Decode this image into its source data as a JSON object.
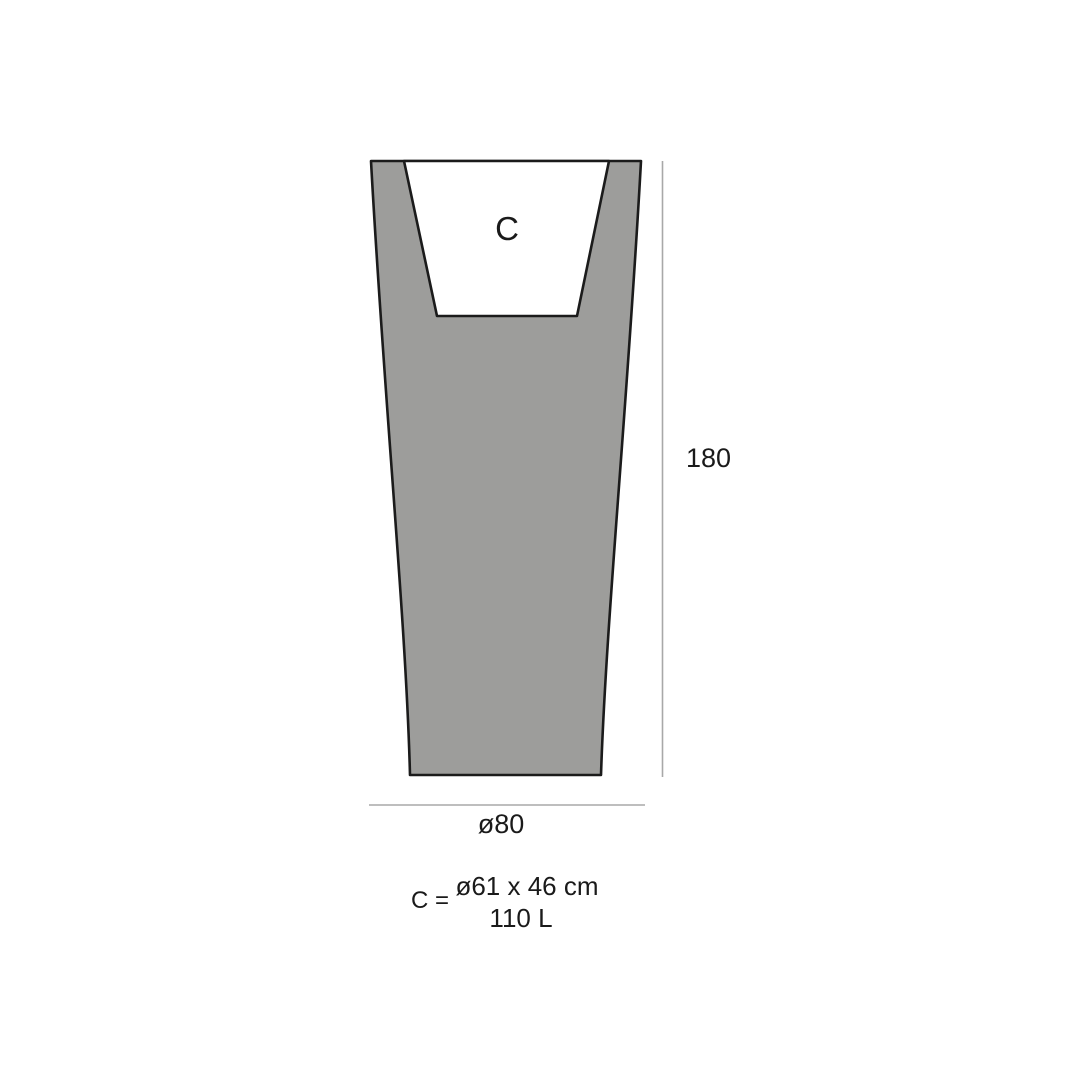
{
  "diagram": {
    "title": "planter-dimension-diagram",
    "cavity_label": "C",
    "height_dimension_label": "180",
    "width_dimension_label": "ø80",
    "legend": {
      "prefix": "C =",
      "line1": "ø61 x 46 cm",
      "line2": "110 L"
    }
  },
  "colors": {
    "background": "#ffffff",
    "body_fill": "#9d9d9b",
    "outline": "#1b1b1b",
    "cavity_fill": "#ffffff",
    "dimension_line": "#a8a8a8",
    "text": "#1a1a1a"
  }
}
